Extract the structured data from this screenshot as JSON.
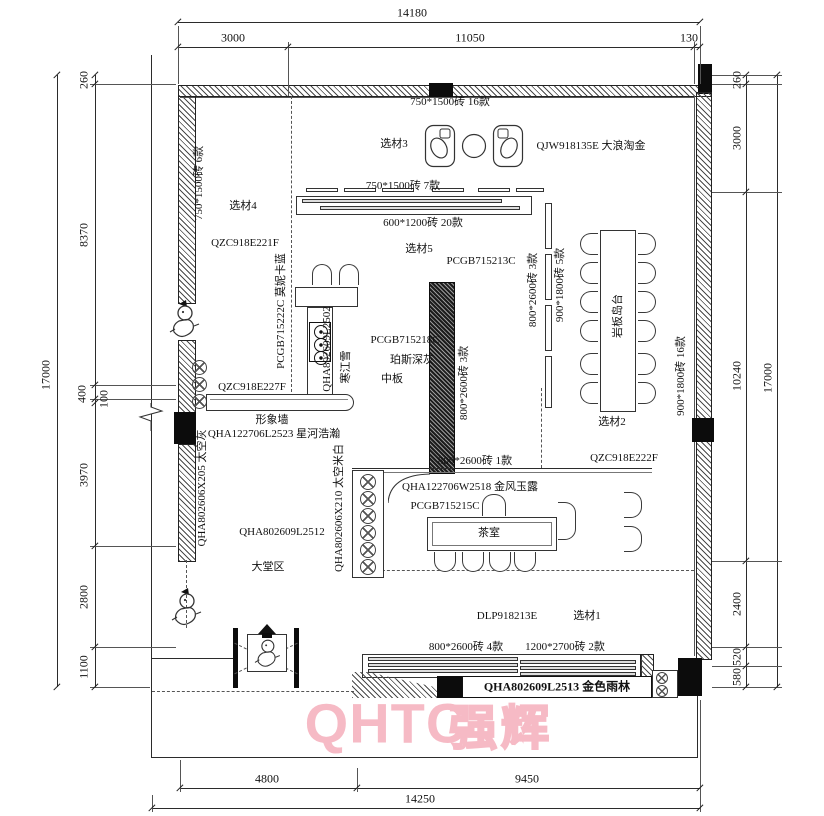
{
  "watermark": {
    "latin": "QHTC",
    "cjk": "强辉",
    "color": "#f6bac5"
  },
  "dims": {
    "top_overall": "14180",
    "top_segments": [
      "3000",
      "11050",
      "130"
    ],
    "bottom_segments": [
      "4800",
      "9450"
    ],
    "bottom_overall": "14250",
    "left_overall": "17000",
    "left_segments": [
      "260",
      "8370",
      "400",
      "100",
      "3970",
      "2800",
      "1100"
    ],
    "right_overall": "17000",
    "right_segments": [
      "260",
      "3000",
      "10240",
      "2400",
      "520",
      "580"
    ]
  },
  "areas": {
    "zone3_tile": "750*1500砖  16款",
    "zone3_label": "选材3",
    "zone3_code": "QJW918135E  大浪淘金",
    "zone5_tile_top": "750*1500砖  7款",
    "zone5_tile_bottom": "600*1200砖  20款",
    "zone5_label": "选材5",
    "zone5_code": "PCGB715213C",
    "zone4_tile": "750*1500砖  6款",
    "zone4_label": "选材4",
    "zone4_code": "QZC918E221F",
    "kitchen_tile_blue": "PCGB715222C  莫妮卡蓝",
    "kitchen_code": "QHA802609L2502",
    "kitchen_name": "寒江雪",
    "kitchen_grey_code": "PCGB715218C",
    "kitchen_grey_name": "珀斯深灰",
    "kitchen_board": "中板",
    "partition_tile": "800*2600砖  3款",
    "island_tile_a": "800*2600砖  3款",
    "island_tile_b": "900*1800砖  5款",
    "island_label": "岩板岛台",
    "island_tile_c": "900*1800砖  16款",
    "zone2_label": "选材2",
    "zone2_code": "QZC918E222F",
    "wall_code": "QZC918E227F",
    "feature_wall": "形象墙",
    "feature_wall_code": "QHA122706L2523  星河浩瀚",
    "left_tile": "QHA802606X205 太空灰",
    "lobby_code": "QHA802609L2512",
    "lobby_label": "大堂区",
    "tea_tile": "800*2600砖  1款",
    "tea_code": "QHA122706W2518  金风玉露",
    "tea_code2": "PCGB715215C",
    "tea_label": "茶室",
    "tea_left_tile": "QHA802606X210 太空米白",
    "zone1_code": "DLP918213E",
    "zone1_label": "选材1",
    "zone1_tile_a": "800*2600砖  4款",
    "zone1_tile_b": "1200*2700砖  2款",
    "zone1_bar": "QHA802609L2513  金色雨林"
  }
}
